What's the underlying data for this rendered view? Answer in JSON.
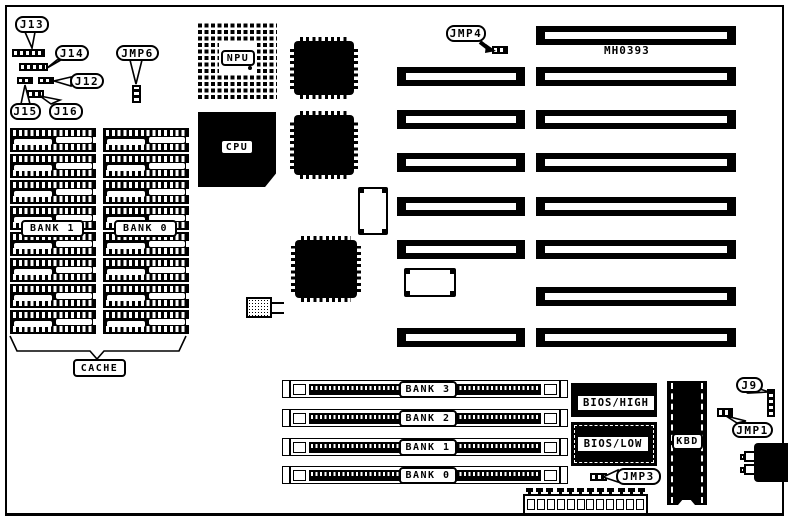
{
  "board": {
    "marking": "MH0393",
    "ink_color": "#000000",
    "paper_color": "#ffffff"
  },
  "processors": {
    "npu_label": "NPU",
    "cpu_label": "CPU"
  },
  "cache": {
    "label": "CACHE",
    "bank_labels": [
      "BANK 1",
      "BANK 0"
    ],
    "columns": 2,
    "chip_rows_per_column": 8
  },
  "memory_banks": [
    "BANK 3",
    "BANK 2",
    "BANK 1",
    "BANK 0"
  ],
  "rom": {
    "high": "BIOS/HIGH",
    "low": "BIOS/LOW"
  },
  "keyboard_controller": "KBD",
  "jumpers": {
    "j13": "J13",
    "j14": "J14",
    "j12": "J12",
    "j15": "J15",
    "j16": "J16",
    "jmp6": "JMP6",
    "jmp4": "JMP4",
    "jmp3": "JMP3",
    "jmp1": "JMP1",
    "j9": "J9"
  },
  "slots": {
    "isa_long_rows": 8,
    "isa_rows_with_short_extension": 6,
    "simm_sockets": 4,
    "power_connector_pins": 12
  }
}
